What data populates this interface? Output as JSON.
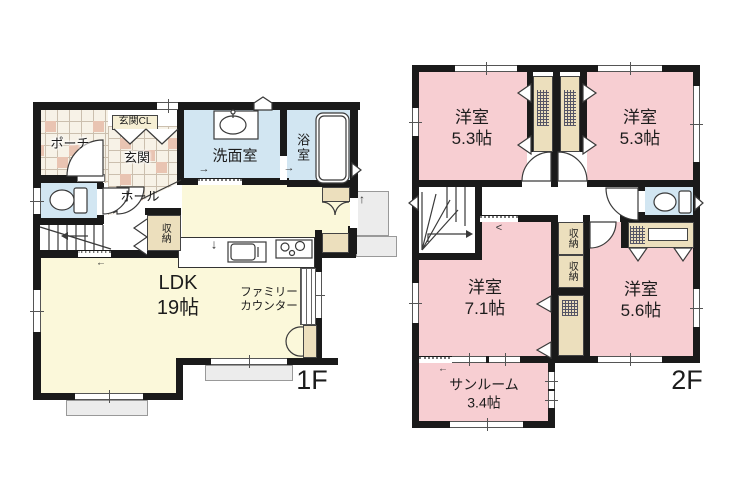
{
  "colors": {
    "wall": "#1a1a1a",
    "line": "#3a3a3a",
    "pink": "#f7ced2",
    "yellow": "#fbf8da",
    "blue": "#d2e6f2",
    "cream": "#ecdfbd",
    "tile-base": "#f7f2e7",
    "tile-line": "#cbbfae",
    "tile-accent": "#e9c4b2",
    "sill": "#ececec",
    "sill-border": "#999999"
  },
  "icons": {
    "slide-door-arrow": "→",
    "entry-arrow": "↓",
    "side-entry-arrow": "↑",
    "opening-arrow-left": "←",
    "opening-chevron": "<",
    "sunroom-opening-arrow": "←"
  },
  "floor1": {
    "label": "1F",
    "rooms": {
      "porch": "ポーチ",
      "entrance_closet": "玄関CL",
      "entrance": "玄関",
      "hall": "ホール",
      "washroom": "洗面室",
      "bathroom": "浴室",
      "storage": "収納",
      "ldk": [
        "LDK",
        "19帖"
      ],
      "family_counter": [
        "ファミリー",
        "カウンター"
      ]
    }
  },
  "floor2": {
    "label": "2F",
    "rooms": {
      "bedroom_nw": [
        "洋室",
        "5.3帖"
      ],
      "bedroom_ne": [
        "洋室",
        "5.3帖"
      ],
      "bedroom_sw": [
        "洋室",
        "7.1帖"
      ],
      "bedroom_se": [
        "洋室",
        "5.6帖"
      ],
      "storage_a": "収納",
      "storage_b": "収納",
      "sunroom": [
        "サンルーム",
        "3.4帖"
      ]
    }
  }
}
